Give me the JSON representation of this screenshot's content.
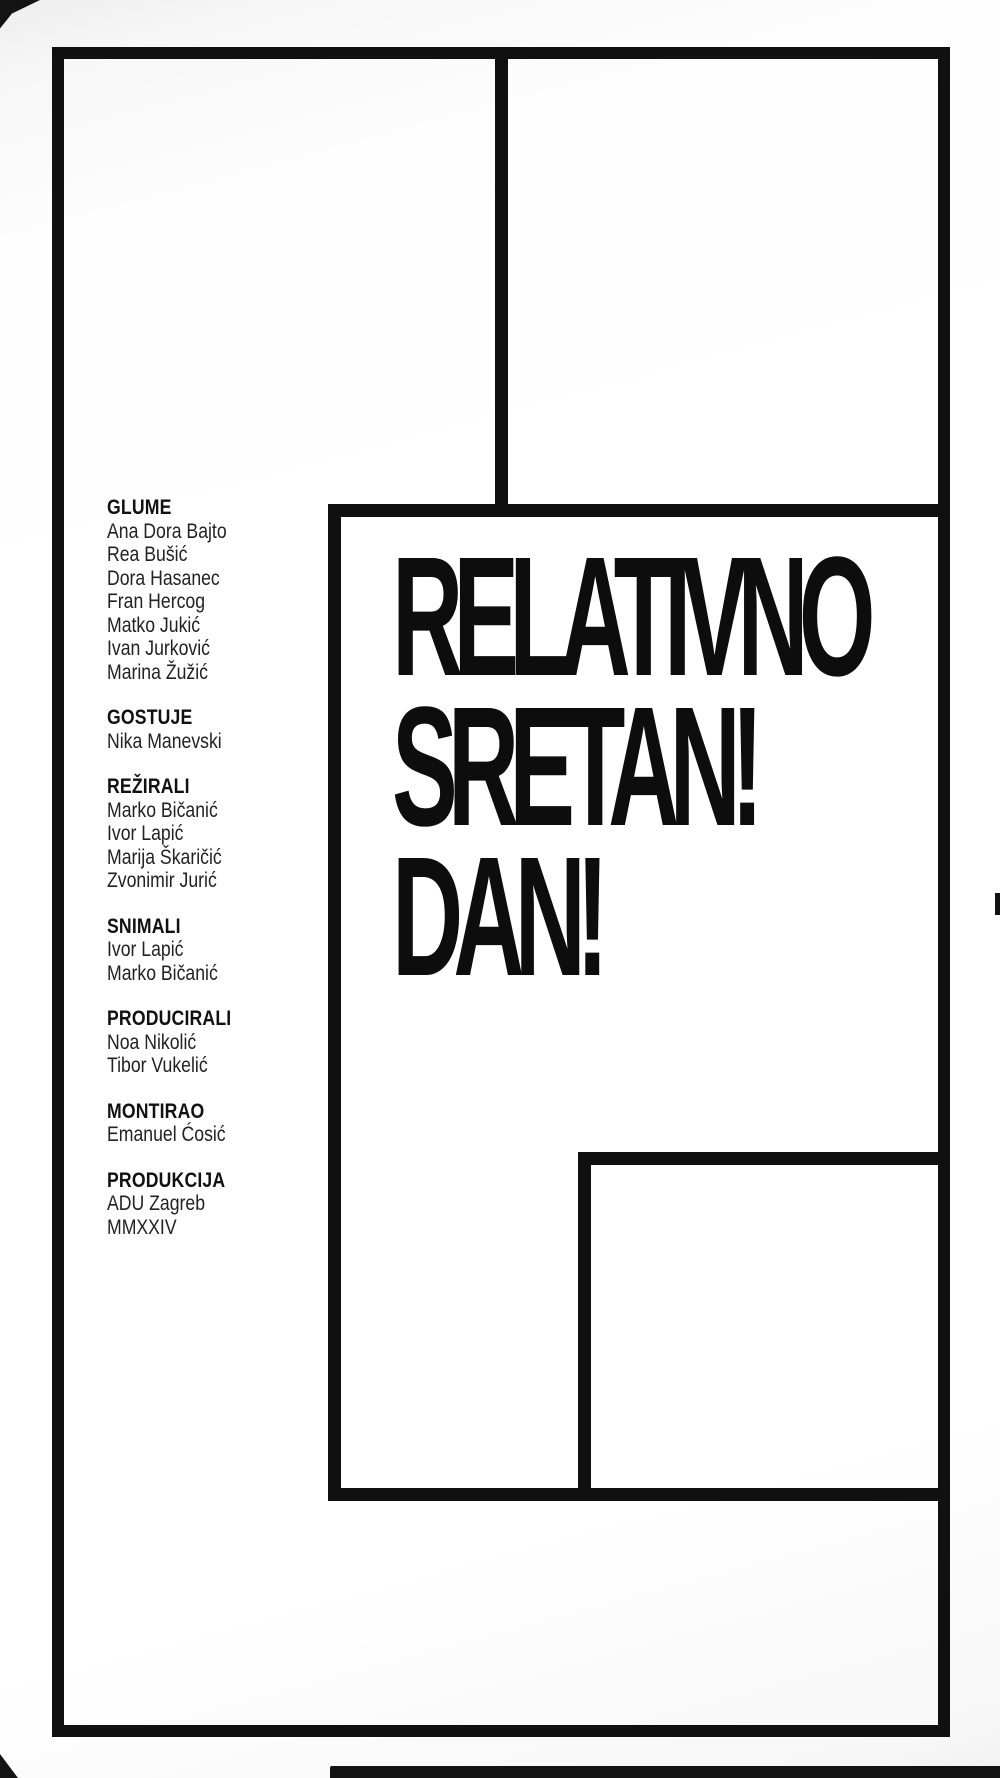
{
  "poster": {
    "title_lines": [
      "RELATIVNO",
      "SRETAN!",
      "DAN!"
    ],
    "credits": {
      "sections": [
        {
          "heading": "GLUME",
          "names": [
            "Ana Dora Bajto",
            "Rea Bušić",
            "Dora Hasanec",
            "Fran Hercog",
            "Matko Jukić",
            "Ivan Jurković",
            "Marina Žužić"
          ]
        },
        {
          "heading": "GOSTUJE",
          "names": [
            "Nika Manevski"
          ]
        },
        {
          "heading": "REŽIRALI",
          "names": [
            "Marko Bičanić",
            "Ivor Lapić",
            "Marija Škaričić",
            "Zvonimir Jurić"
          ]
        },
        {
          "heading": "SNIMALI",
          "names": [
            "Ivor Lapić",
            "Marko Bičanić"
          ]
        },
        {
          "heading": "PRODUCIRALI",
          "names": [
            "Noa Nikolić",
            "Tibor Vukelić"
          ]
        },
        {
          "heading": "MONTIRAO",
          "names": [
            "Emanuel Ćosić"
          ]
        },
        {
          "heading": "PRODUKCIJA",
          "names": [
            "ADU Zagreb",
            "MMXXIV"
          ]
        }
      ]
    },
    "colors": {
      "ink": "#101010",
      "paper": "#ffffff"
    }
  }
}
